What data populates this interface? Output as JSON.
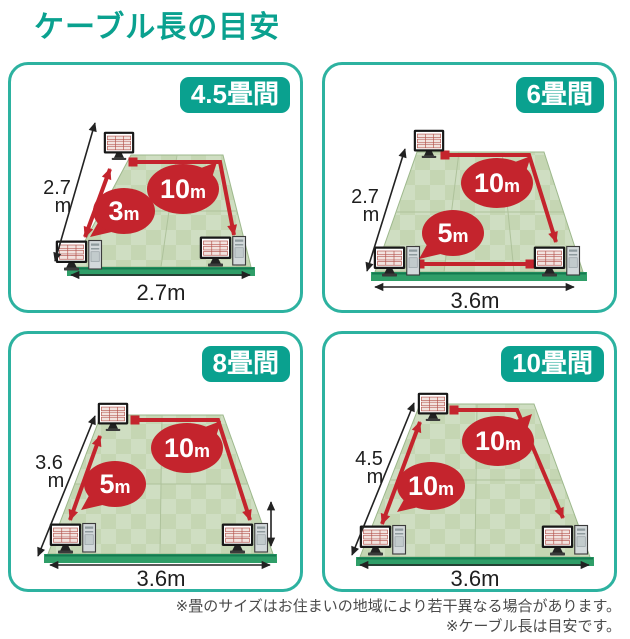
{
  "title": "ケーブル長の目安",
  "colors": {
    "teal_accent": "#0aa18f",
    "panel_border": "#2db2a0",
    "cable_red": "#c4242d",
    "floor_green": "#cfdec2",
    "floor_check": "#c5d6b3",
    "floor_front_edge": "#2f9e68",
    "dim_text": "#1e1e1e",
    "note_text": "#4a4a4a"
  },
  "icons": {
    "desktop-pc-icon": "monitor with tower unit",
    "monitor-icon": "standalone monitor",
    "dimension-arrow-icon": "black double-headed measuring arrow",
    "cable-arrow-icon": "red cable route arrow with square start"
  },
  "panels": [
    {
      "badge": "4.5畳間",
      "dim_left": {
        "value": "2.7",
        "unit": "m"
      },
      "dim_bottom": "2.7m",
      "cables": [
        {
          "value": "3",
          "unit": "m",
          "route": "left-edge"
        },
        {
          "value": "10",
          "unit": "m",
          "route": "top-and-right-edge"
        }
      ]
    },
    {
      "badge": "6畳間",
      "dim_left": {
        "value": "2.7",
        "unit": "m"
      },
      "dim_bottom": "3.6m",
      "cables": [
        {
          "value": "5",
          "unit": "m",
          "route": "bottom-edge"
        },
        {
          "value": "10",
          "unit": "m",
          "route": "top-and-right-edge"
        }
      ]
    },
    {
      "badge": "8畳間",
      "dim_left": {
        "value": "3.6",
        "unit": "m"
      },
      "dim_bottom": "3.6m",
      "cables": [
        {
          "value": "5",
          "unit": "m",
          "route": "left-edge"
        },
        {
          "value": "10",
          "unit": "m",
          "route": "top-and-right-edge"
        }
      ]
    },
    {
      "badge": "10畳間",
      "dim_left": {
        "value": "4.5",
        "unit": "m"
      },
      "dim_bottom": "3.6m",
      "cables": [
        {
          "value": "10",
          "unit": "m",
          "route": "left-edge"
        },
        {
          "value": "10",
          "unit": "m",
          "route": "top-and-right-edge"
        }
      ]
    }
  ],
  "notes": [
    "※畳のサイズはお住まいの地域により若干異なる場合があります。",
    "※ケーブル長は目安です。"
  ]
}
